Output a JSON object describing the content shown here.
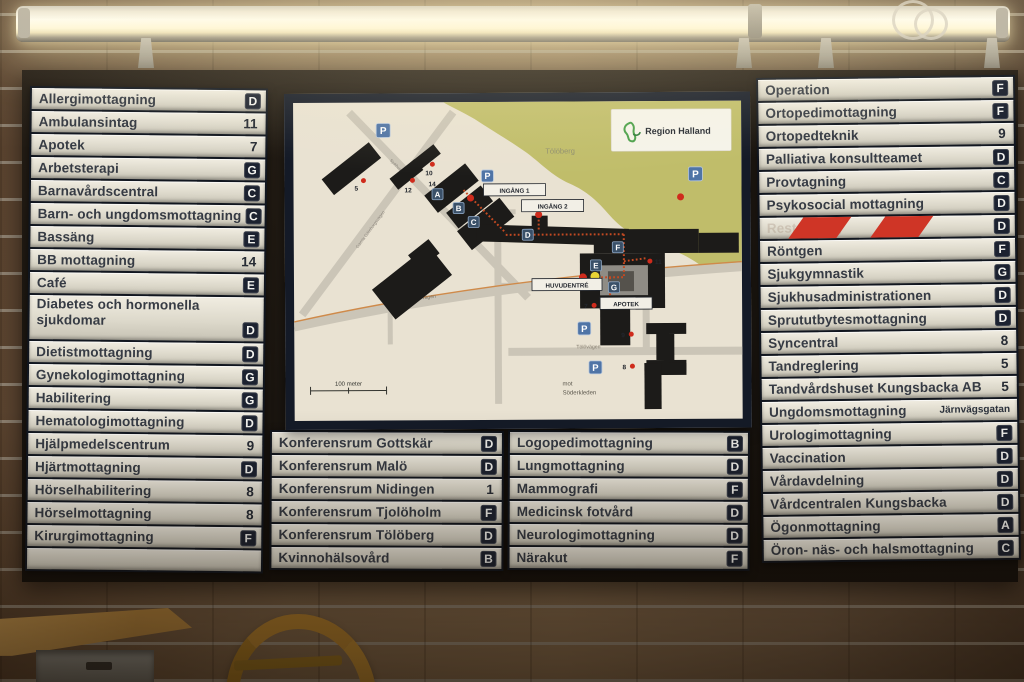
{
  "sign": {
    "left_column": {
      "rows": [
        {
          "label": "Allergimottagning",
          "badge": "D",
          "badge_type": "letter"
        },
        {
          "label": "Ambulansintag",
          "badge": "11",
          "badge_type": "number"
        },
        {
          "label": "Apotek",
          "badge": "7",
          "badge_type": "number"
        },
        {
          "label": "Arbetsterapi",
          "badge": "G",
          "badge_type": "letter"
        },
        {
          "label": "Barnavårdscentral",
          "badge": "C",
          "badge_type": "letter"
        },
        {
          "label": "Barn- och ungdomsmottagning",
          "badge": "C",
          "badge_type": "letter"
        },
        {
          "label": "Bassäng",
          "badge": "E",
          "badge_type": "letter"
        },
        {
          "label": "BB mottagning",
          "badge": "14",
          "badge_type": "number"
        },
        {
          "label": "Café",
          "badge": "E",
          "badge_type": "letter"
        },
        {
          "label": "Diabetes och hormonella sjukdomar",
          "badge": "D",
          "badge_type": "letter",
          "tall": true
        },
        {
          "label": "Dietistmottagning",
          "badge": "D",
          "badge_type": "letter"
        },
        {
          "label": "Gynekologimottagning",
          "badge": "G",
          "badge_type": "letter"
        },
        {
          "label": "Habilitering",
          "badge": "G",
          "badge_type": "letter"
        },
        {
          "label": "Hematologimottagning",
          "badge": "D",
          "badge_type": "letter"
        },
        {
          "label": "Hjälpmedelscentrum",
          "badge": "9",
          "badge_type": "number"
        },
        {
          "label": "Hjärtmottagning",
          "badge": "D",
          "badge_type": "letter"
        },
        {
          "label": "Hörselhabilitering",
          "badge": "8",
          "badge_type": "number"
        },
        {
          "label": "Hörselmottagning",
          "badge": "8",
          "badge_type": "number"
        },
        {
          "label": "Kirurgimottagning",
          "badge": "F",
          "badge_type": "letter"
        },
        {
          "label": "",
          "badge": "",
          "badge_type": "none",
          "empty": true
        }
      ]
    },
    "middle_columns": [
      {
        "rows": [
          {
            "label": "Konferensrum Gottskär",
            "badge": "D",
            "badge_type": "letter"
          },
          {
            "label": "Konferensrum Malö",
            "badge": "D",
            "badge_type": "letter"
          },
          {
            "label": "Konferensrum Nidingen",
            "badge": "1",
            "badge_type": "number"
          },
          {
            "label": "Konferensrum Tjolöholm",
            "badge": "F",
            "badge_type": "letter"
          },
          {
            "label": "Konferensrum Tölöberg",
            "badge": "D",
            "badge_type": "letter"
          },
          {
            "label": "Kvinnohälsovård",
            "badge": "B",
            "badge_type": "letter"
          }
        ]
      },
      {
        "rows": [
          {
            "label": "Logopedimottagning",
            "badge": "B",
            "badge_type": "letter"
          },
          {
            "label": "Lungmottagning",
            "badge": "D",
            "badge_type": "letter"
          },
          {
            "label": "Mammografi",
            "badge": "F",
            "badge_type": "letter"
          },
          {
            "label": "Medicinsk fotvård",
            "badge": "D",
            "badge_type": "letter"
          },
          {
            "label": "Neurologimottagning",
            "badge": "D",
            "badge_type": "letter"
          },
          {
            "label": "Närakut",
            "badge": "F",
            "badge_type": "letter"
          }
        ]
      }
    ],
    "right_column": {
      "rows": [
        {
          "label": "Operation",
          "badge": "F",
          "badge_type": "letter"
        },
        {
          "label": "Ortopedimottagning",
          "badge": "F",
          "badge_type": "letter"
        },
        {
          "label": "Ortopedteknik",
          "badge": "9",
          "badge_type": "number"
        },
        {
          "label": "Palliativa konsultteamet",
          "badge": "D",
          "badge_type": "letter"
        },
        {
          "label": "Provtagning",
          "badge": "C",
          "badge_type": "letter"
        },
        {
          "label": "Psykosocial mottagning",
          "badge": "D",
          "badge_type": "letter"
        },
        {
          "label": "Restaurang",
          "badge": "D",
          "badge_type": "letter",
          "taped": true
        },
        {
          "label": "Röntgen",
          "badge": "F",
          "badge_type": "letter"
        },
        {
          "label": "Sjukgymnastik",
          "badge": "G",
          "badge_type": "letter"
        },
        {
          "label": "Sjukhusadministrationen",
          "badge": "D",
          "badge_type": "letter"
        },
        {
          "label": "Sprututbytesmottagning",
          "badge": "D",
          "badge_type": "letter"
        },
        {
          "label": "Syncentral",
          "badge": "8",
          "badge_type": "number"
        },
        {
          "label": "Tandreglering",
          "badge": "5",
          "badge_type": "number"
        },
        {
          "label": "Tandvårdshuset Kungsbacka AB",
          "badge": "5",
          "badge_type": "number"
        },
        {
          "label": "Ungdomsmottagning",
          "badge": "Järnvägsgatan",
          "badge_type": "text"
        },
        {
          "label": "Urologimottagning",
          "badge": "F",
          "badge_type": "letter"
        },
        {
          "label": "Vaccination",
          "badge": "D",
          "badge_type": "letter"
        },
        {
          "label": "Vårdavdelning",
          "badge": "D",
          "badge_type": "letter"
        },
        {
          "label": "Vårdcentralen Kungsbacka",
          "badge": "D",
          "badge_type": "letter"
        },
        {
          "label": "Ögonmottagning",
          "badge": "A",
          "badge_type": "letter"
        },
        {
          "label": "Öron- näs- och halsmottagning",
          "badge": "C",
          "badge_type": "letter"
        }
      ]
    }
  },
  "map": {
    "logo": "Region Halland",
    "hill_label": "Tölöberg",
    "scale_label": "100 meter",
    "direction_note": [
      "mot",
      "Söderkleden"
    ],
    "labels": {
      "entrance1": "INGÅNG 1",
      "entrance2": "INGÅNG 2",
      "main_entrance": "HUVUDENTRÉ",
      "pharmacy": "APOTEK"
    },
    "road_labels": [
      "Gamla Göteborgsvägen",
      "Sjukhusvägen",
      "Tölövägen",
      "Tölövägen"
    ],
    "building_letters": [
      "A",
      "B",
      "C",
      "D",
      "E",
      "F",
      "G"
    ],
    "building_numbers": [
      "5",
      "10",
      "12",
      "14",
      "7",
      "9",
      "8",
      "11"
    ],
    "parking_symbol": "P"
  },
  "colors": {
    "badge_navy": "#1c2230",
    "slat_cream": "#dcd8ca",
    "map_green": "#c0bd6a",
    "entrance_red": "#cf2b1c",
    "parking_blue": "#4f74a6",
    "hazard_red": "#cf3526"
  }
}
